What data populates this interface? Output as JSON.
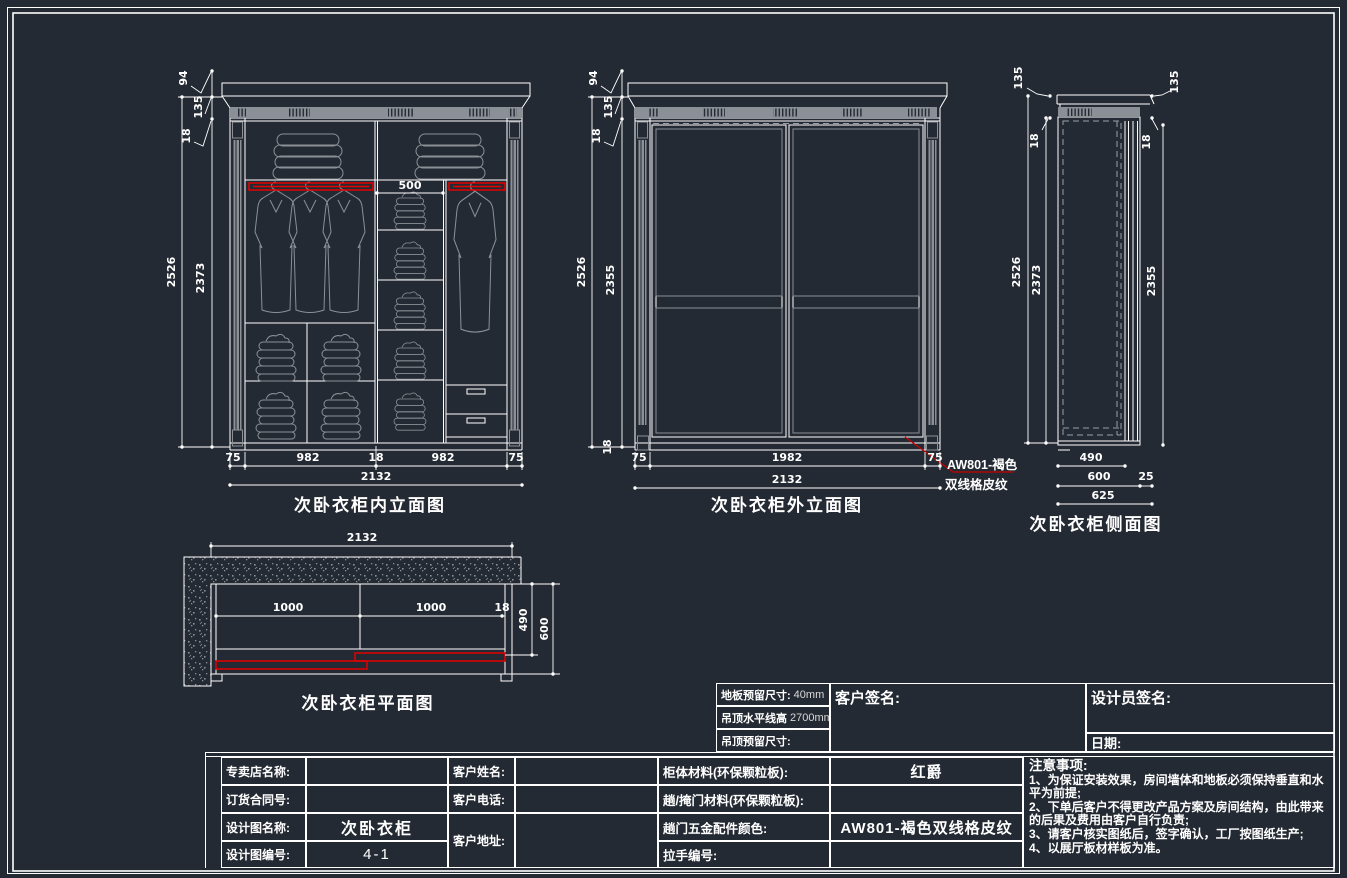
{
  "colors": {
    "background": "#242a33",
    "line": "#ffffff",
    "gray": "#8b9097",
    "red": "#e50000"
  },
  "drawings": {
    "interior": {
      "title": "次卧衣柜内立面图",
      "dim_top": {
        "d94": "94",
        "d135": "135",
        "d18": "18"
      },
      "dim_left": {
        "total": "2526",
        "inner": "2373"
      },
      "dim_shelf": "500",
      "dim_bottom": [
        "75",
        "982",
        "18",
        "982",
        "75"
      ],
      "dim_total": "2132"
    },
    "exterior": {
      "title": "次卧衣柜外立面图",
      "dim_top": {
        "d94": "94",
        "d135": "135",
        "d18": "18"
      },
      "dim_left": {
        "total": "2526",
        "door": "2355"
      },
      "dim_base": "18",
      "dim_bottom": [
        "75",
        "1982",
        "75"
      ],
      "dim_total": "2132",
      "leader_line1": "AW801-褐色",
      "leader_line2": "双线格皮纹"
    },
    "side": {
      "title": "次卧衣柜侧面图",
      "dim_left": {
        "d135": "135",
        "d18": "18",
        "total": "2526",
        "inner": "2373"
      },
      "dim_right": {
        "d135": "135",
        "d18": "18",
        "door": "2355"
      },
      "dim_bottom": {
        "d490": "490",
        "d600": "600",
        "d25": "25",
        "d625": "625"
      }
    },
    "plan": {
      "title": "次卧衣柜平面图",
      "dim_total": "2132",
      "dim_inner": [
        "1000",
        "1000",
        "18"
      ],
      "dim_right": {
        "d490": "490",
        "d600": "600"
      }
    }
  },
  "presets": {
    "rows": [
      {
        "label": "地板预留尺寸:",
        "value": "40mm"
      },
      {
        "label": "吊顶水平线高",
        "value": "2700mm"
      },
      {
        "label": "吊顶预留尺寸:",
        "value": ""
      }
    ],
    "customer_sign": "客户签名:",
    "designer_sign": "设计员签名:",
    "date_label": "日期:"
  },
  "title_block": {
    "store_label": "专卖店名称:",
    "store_value": "",
    "contract_label": "订货合同号:",
    "contract_value": "",
    "drawing_name_label": "设计图名称:",
    "drawing_name_value": "次卧衣柜",
    "drawing_no_label": "设计图编号:",
    "drawing_no_value": "4-1",
    "customer_name_label": "客户姓名:",
    "customer_name_value": "",
    "customer_phone_label": "客户电话:",
    "customer_phone_value": "",
    "customer_addr_label": "客户地址:",
    "customer_addr_value": "",
    "cabinet_material_label": "柜体材料(环保颗粒板):",
    "cabinet_material_value": "红爵",
    "door_material_label": "趟/掩门材料(环保颗粒板):",
    "door_material_value": "",
    "hardware_color_label": "趟门五金配件颜色:",
    "hardware_color_value": "AW801-褐色双线格皮纹",
    "handle_no_label": "拉手编号:",
    "handle_no_value": ""
  },
  "notes": {
    "heading": "注意事项:",
    "items": [
      "1、为保证安装效果，房间墙体和地板必须保持垂直和水平为前提;",
      "2、下单后客户不得更改产品方案及房间结构，由此带来的后果及费用由客户自行负责;",
      "3、请客户核实图纸后，签字确认，工厂按图纸生产;",
      "4、以展厅板材样板为准。"
    ]
  }
}
